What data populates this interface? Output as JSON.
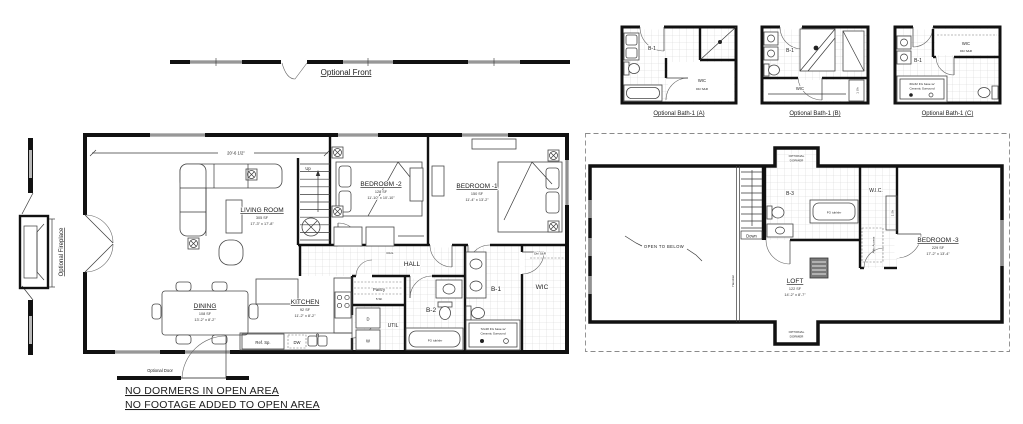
{
  "annotations": {
    "optional_front": "Optional Front",
    "optional_fireplace": "Optional Fireplace",
    "optional_door": "Optional Door",
    "note_line1": "NO DORMERS IN OPEN AREA",
    "note_line2": "NO FOOTAGE ADDED TO OPEN AREA"
  },
  "first_floor": {
    "dimension_top": "20'-6 1/2\"",
    "living": {
      "name": "LIVING ROOM",
      "area": "305 SF",
      "dims": "17'-3\" x 17'-8\""
    },
    "dining": {
      "name": "DINING",
      "area": "108 SF",
      "dims": "13'-2\" x 8'-2\""
    },
    "kitchen": {
      "name": "KITCHEN",
      "area": "92 SF",
      "dims": "11'-2\" x 8'-2\""
    },
    "bedroom2": {
      "name": "BEDROOM -2",
      "area": "128 SF",
      "dims": "11'-10\" x 10'-10\""
    },
    "bedroom1": {
      "name": "BEDROOM -1",
      "area": "150 SF",
      "dims": "11'-4\" x 13'-2\""
    },
    "hall": "HALL",
    "rail": "RAIL",
    "up": "Up",
    "pantry": "Pantry",
    "pantry_shelves": "5 Sh",
    "util": "UTIL",
    "dryer": "D",
    "washer": "W",
    "bath2": "B-2",
    "bath1": "B-1",
    "wic": "WIC",
    "wic_note": "Dbl S&R",
    "ref_space": "Ref. Sp.",
    "dishwasher": "DW",
    "tub": "FG tub/shr",
    "shower_line1": "72x48 FG base w/",
    "shower_line2": "Ceramic Surround"
  },
  "second_floor": {
    "loft": {
      "name": "LOFT",
      "area": "122 SF",
      "dims": "14'-2\" x 8'-7\""
    },
    "bedroom3": {
      "name": "BEDROOM -3",
      "area": "229 SF",
      "dims": "17'-2\" x 13'-4\""
    },
    "bath3": "B-3",
    "wic": "W.I.C.",
    "one_shelf": "1 Sh",
    "down": "Down",
    "handrail": "Handrail",
    "open_to_below": "OPEN TO BELOW",
    "attic_access": "Attic Access",
    "tub": "FG tub/shr",
    "dormer_line1": "OPTIONAL",
    "dormer_line2": "DORMER"
  },
  "bath_options": [
    {
      "title": "Optional Bath-1 (A)",
      "room": "B-1",
      "closet": "WIC",
      "closet_note": "Dbl S&R"
    },
    {
      "title": "Optional Bath-1 (B)",
      "room": "B-1",
      "closet": "WIC",
      "closet_note": "1 Sh"
    },
    {
      "title": "Optional Bath-1 (C)",
      "room": "B-1",
      "closet": "WIC",
      "closet_note": "Dbl S&R",
      "shower_line1": "60x32 FG base w/",
      "shower_line2": "Ceramic Surround"
    }
  ]
}
